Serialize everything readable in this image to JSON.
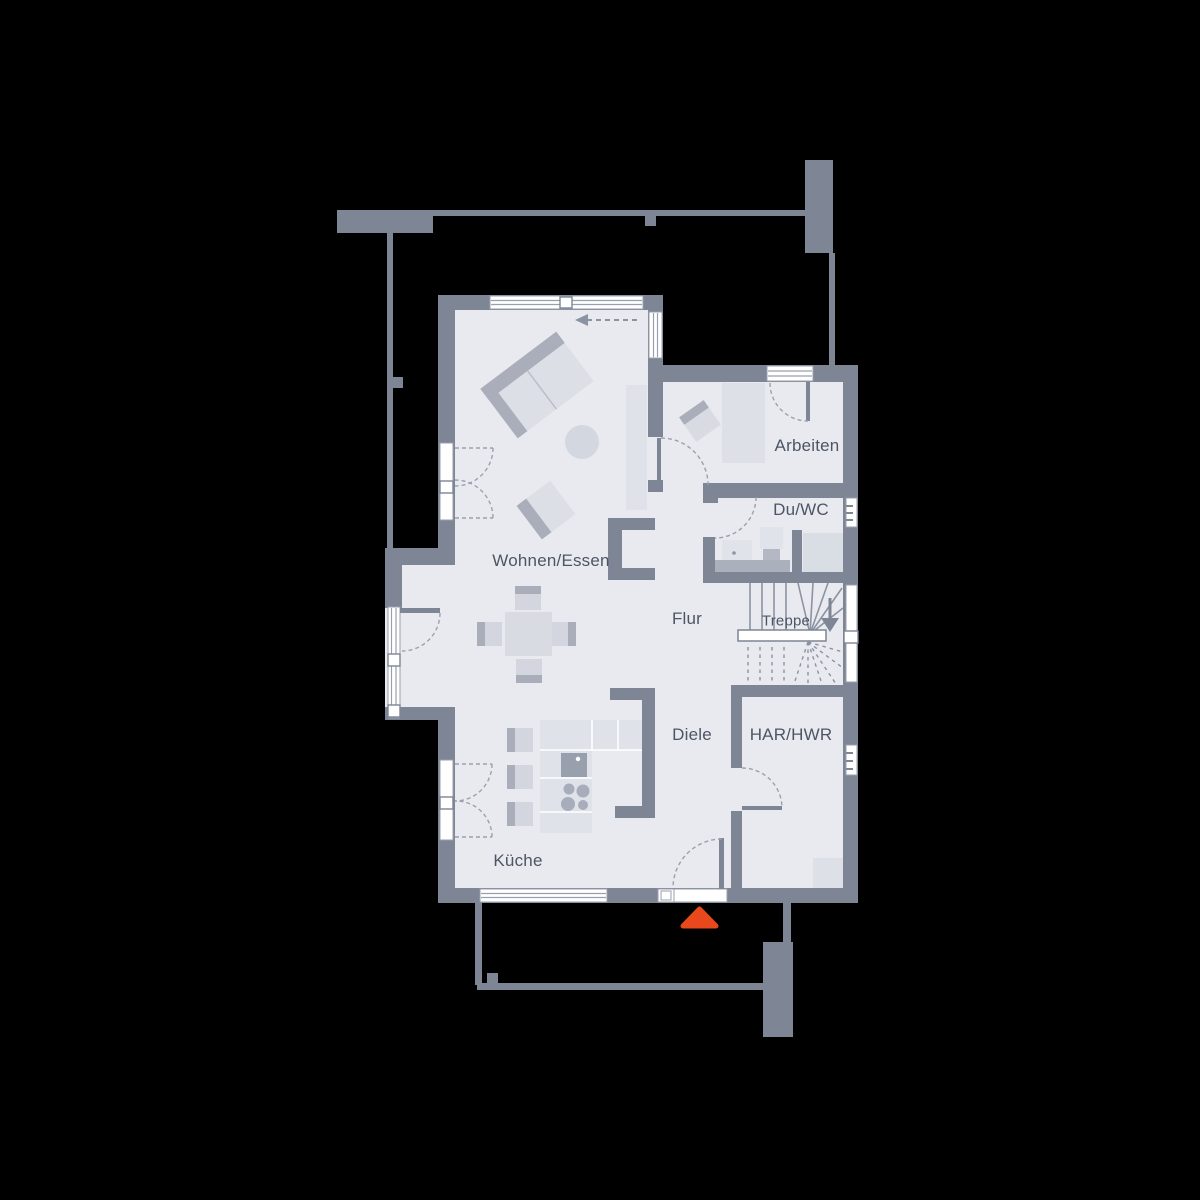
{
  "plan": {
    "title": "Erdgeschoss Grundriss",
    "background": "#000000"
  },
  "palette": {
    "wall": "#7e8594",
    "room_fill": "#e9eaef",
    "furniture_light": "#dde0e7",
    "furniture_mid": "#d3d6de",
    "furniture_dark": "#a9aeba",
    "fixture_dark": "#99a0ad",
    "thin_line": "#8b93a2",
    "dashed_line": "#99a1af",
    "window_white": "#ffffff",
    "label_text": "#4d5565",
    "entrance_accent": "#e8481b"
  },
  "rooms": [
    {
      "id": "wohnen-essen",
      "label": "Wohnen/Essen"
    },
    {
      "id": "arbeiten",
      "label": "Arbeiten"
    },
    {
      "id": "du-wc",
      "label": "Du/WC"
    },
    {
      "id": "treppe",
      "label": "Treppe"
    },
    {
      "id": "flur",
      "label": "Flur"
    },
    {
      "id": "diele",
      "label": "Diele"
    },
    {
      "id": "har-hwr",
      "label": "HAR/HWR"
    },
    {
      "id": "kueche",
      "label": "Küche"
    }
  ],
  "markers": {
    "entrance": {
      "name": "entrance-arrow",
      "color": "#e8481b"
    }
  }
}
